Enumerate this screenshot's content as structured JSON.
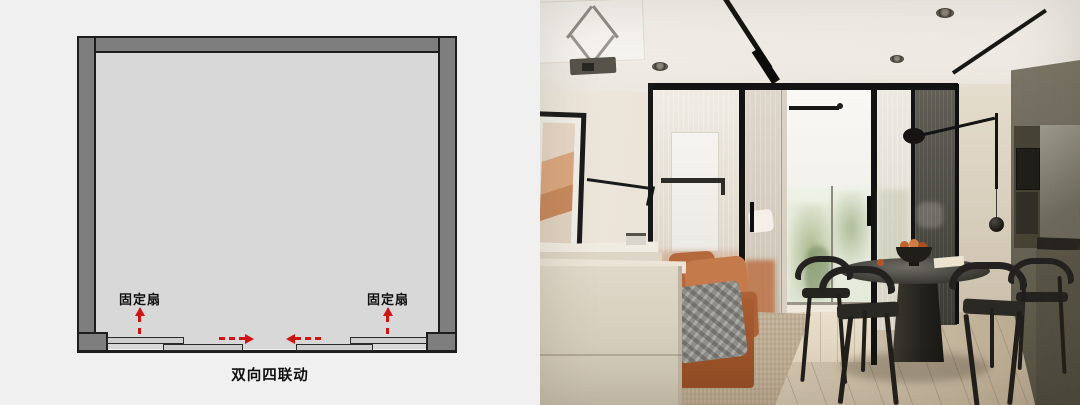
{
  "window": {
    "width": 1080,
    "height": 405
  },
  "diagram": {
    "caption": "双向四联动",
    "fixed_panel_labels": [
      "固定扇",
      "固定扇"
    ],
    "arrows": [
      {
        "id": "left-fixed-panel",
        "direction": "up"
      },
      {
        "id": "right-fixed-panel",
        "direction": "up"
      },
      {
        "id": "left-sliding-panel",
        "direction": "right"
      },
      {
        "id": "right-sliding-panel",
        "direction": "left"
      }
    ],
    "colors": {
      "background": "#f0f0f0",
      "wall_fill": "#7e7e7e",
      "wall_outline": "#1d1d1d",
      "room_fill": "#d8d8d8",
      "panel_fill": "#cdcdcd",
      "arrow_red": "#cf1414",
      "text": "#101010"
    }
  },
  "photo": {
    "elements": [
      "projector-ceiling-lift",
      "track-lights",
      "recessed-spotlights",
      "glass-partition",
      "wall-art",
      "swing-arm-wall-lamp",
      "orange-sofa",
      "plaid-throw",
      "cream-cabinet",
      "window-with-roller-blind",
      "greenery-view",
      "wood-floor",
      "woven-rug",
      "round-black-dining-table",
      "fruit-bowl",
      "black-chairs",
      "rod-pendant-lamp",
      "disc-wall-lamp",
      "olive-kitchen-cabinets",
      "built-in-oven"
    ],
    "colors": {
      "ceiling": "#f4f1eb",
      "wall_cream": "#e8e0d3",
      "floor_wood": "#cfc2ad",
      "rug": "#c3b39c",
      "sofa_orange": "#bf7245",
      "throw_gray": "#8b8a84",
      "glass_frame_black": "#161616",
      "smoked_glass": "#4c4b45",
      "kitchen_olive": "#6b675a",
      "furniture_black": "#242220",
      "window_light": "#f6f5f1",
      "greenery": "#c9d2b8"
    }
  }
}
